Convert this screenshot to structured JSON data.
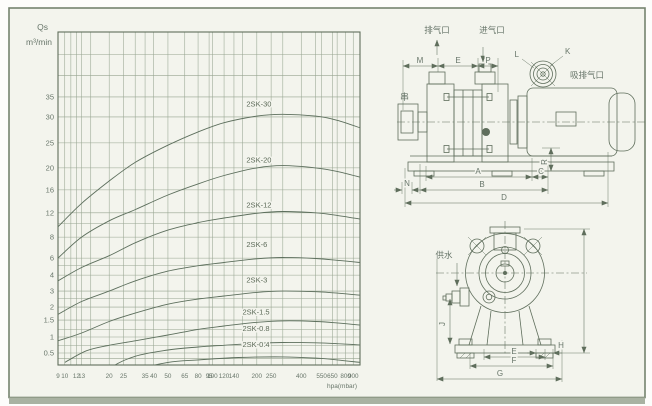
{
  "colors": {
    "paper": "#f3f4ed",
    "ink": "#5f6e5c",
    "grid": "#97a591",
    "curve": "#5d6f5d",
    "text": "#68766a",
    "edge_band": "#a9b2a2",
    "frame": "#76846e"
  },
  "chart_data": {
    "type": "line",
    "title": "",
    "x_axis": {
      "unit_label": "hpa(mbar)",
      "scale": "log",
      "min": 9,
      "max": 1000,
      "tick_values": [
        9,
        10,
        12,
        13,
        20,
        25,
        35,
        40,
        50,
        65,
        80,
        95,
        100,
        120,
        140,
        200,
        250,
        400,
        550,
        650,
        800,
        900
      ],
      "extra_grid_values": [
        11,
        15,
        30,
        160,
        300,
        500,
        700,
        1000
      ]
    },
    "y_axis": {
      "label_line1": "Qs",
      "label_line2": "m³/min",
      "scale": "log-irregular",
      "tick_values": [
        35,
        30,
        25,
        20,
        16,
        12,
        8,
        6,
        4,
        3,
        2,
        1.5,
        1,
        0.5
      ],
      "extra_grid_values": [
        45,
        40,
        10,
        5,
        2.5,
        1.2,
        0.7,
        0.45
      ],
      "anchors": [
        [
          50,
          0
        ],
        [
          45,
          0.068
        ],
        [
          40,
          0.13
        ],
        [
          35,
          0.195
        ],
        [
          30,
          0.255
        ],
        [
          25,
          0.333
        ],
        [
          20,
          0.408
        ],
        [
          16,
          0.474
        ],
        [
          12,
          0.543
        ],
        [
          8,
          0.616
        ],
        [
          6,
          0.679
        ],
        [
          4,
          0.73
        ],
        [
          3,
          0.778
        ],
        [
          2,
          0.826
        ],
        [
          1.5,
          0.865
        ],
        [
          1,
          0.916
        ],
        [
          0.5,
          0.964
        ],
        [
          0.4,
          1.0
        ],
        [
          0.2,
          1.15
        ]
      ]
    },
    "legend_position": "labels-on-curves",
    "grid": true,
    "series": [
      {
        "name": "2SK-30",
        "label_at": [
          170,
          32.5
        ],
        "points": [
          [
            9,
            9.5
          ],
          [
            13,
            13.5
          ],
          [
            20,
            17.5
          ],
          [
            30,
            21
          ],
          [
            50,
            24.5
          ],
          [
            80,
            27
          ],
          [
            120,
            28.8
          ],
          [
            200,
            30.2
          ],
          [
            300,
            30.6
          ],
          [
            500,
            30.2
          ],
          [
            700,
            29.3
          ],
          [
            1000,
            27.8
          ]
        ]
      },
      {
        "name": "2SK-20",
        "label_at": [
          170,
          21
        ],
        "points": [
          [
            9,
            6
          ],
          [
            13,
            8
          ],
          [
            20,
            10.5
          ],
          [
            30,
            12.5
          ],
          [
            50,
            15
          ],
          [
            80,
            17
          ],
          [
            120,
            18.5
          ],
          [
            200,
            20
          ],
          [
            300,
            20.4
          ],
          [
            500,
            20
          ],
          [
            700,
            19.3
          ],
          [
            1000,
            18.2
          ]
        ]
      },
      {
        "name": "2SK-12",
        "label_at": [
          170,
          12.8
        ],
        "points": [
          [
            9,
            3.6
          ],
          [
            13,
            4.8
          ],
          [
            20,
            6.2
          ],
          [
            30,
            7.4
          ],
          [
            50,
            9
          ],
          [
            80,
            10.2
          ],
          [
            120,
            11
          ],
          [
            200,
            11.9
          ],
          [
            300,
            12.2
          ],
          [
            500,
            12
          ],
          [
            700,
            11.5
          ],
          [
            1000,
            10.8
          ]
        ]
      },
      {
        "name": "2SK-6",
        "label_at": [
          170,
          7
        ],
        "points": [
          [
            9,
            1.7
          ],
          [
            13,
            2.3
          ],
          [
            20,
            3
          ],
          [
            30,
            3.6
          ],
          [
            50,
            4.4
          ],
          [
            80,
            5
          ],
          [
            120,
            5.4
          ],
          [
            200,
            5.9
          ],
          [
            300,
            6.05
          ],
          [
            500,
            5.95
          ],
          [
            700,
            5.7
          ],
          [
            1000,
            5.4
          ]
        ]
      },
      {
        "name": "2SK-3",
        "label_at": [
          170,
          3.5
        ],
        "points": [
          [
            9,
            0.85
          ],
          [
            13,
            1.1
          ],
          [
            20,
            1.45
          ],
          [
            30,
            1.75
          ],
          [
            50,
            2.15
          ],
          [
            80,
            2.45
          ],
          [
            120,
            2.65
          ],
          [
            200,
            2.9
          ],
          [
            300,
            3
          ],
          [
            500,
            2.95
          ],
          [
            700,
            2.85
          ],
          [
            1000,
            2.7
          ]
        ]
      },
      {
        "name": "2SK-1.5",
        "label_at": [
          160,
          1.7
        ],
        "points": [
          [
            10,
            0.42
          ],
          [
            14,
            0.55
          ],
          [
            20,
            0.7
          ],
          [
            30,
            0.85
          ],
          [
            50,
            1.05
          ],
          [
            80,
            1.2
          ],
          [
            120,
            1.3
          ],
          [
            200,
            1.42
          ],
          [
            300,
            1.47
          ],
          [
            500,
            1.45
          ],
          [
            700,
            1.4
          ],
          [
            1000,
            1.33
          ]
        ]
      },
      {
        "name": "2SK-0.8",
        "label_at": [
          160,
          1.15
        ],
        "points": [
          [
            12,
            0.26
          ],
          [
            20,
            0.38
          ],
          [
            30,
            0.47
          ],
          [
            50,
            0.57
          ],
          [
            80,
            0.65
          ],
          [
            120,
            0.7
          ],
          [
            200,
            0.76
          ],
          [
            300,
            0.79
          ],
          [
            500,
            0.78
          ],
          [
            700,
            0.75
          ],
          [
            1000,
            0.71
          ]
        ]
      },
      {
        "name": "2SK-0.4",
        "label_at": [
          160,
          0.65
        ],
        "points": [
          [
            14,
            0.2
          ],
          [
            20,
            0.3
          ],
          [
            30,
            0.37
          ],
          [
            50,
            0.42
          ],
          [
            80,
            0.44
          ],
          [
            150,
            0.46
          ],
          [
            300,
            0.465
          ],
          [
            500,
            0.455
          ],
          [
            700,
            0.44
          ],
          [
            1000,
            0.42
          ]
        ]
      }
    ]
  },
  "side_view": {
    "exhaust_port": "排气口",
    "intake_port": "进气口",
    "suction_exhaust_port": "吸排气口",
    "mark": "串",
    "dim_m": "M",
    "dim_e": "E",
    "dim_p": "P",
    "dim_l": "L",
    "dim_k": "K",
    "dim_a": "A",
    "dim_b": "B",
    "dim_c": "C",
    "dim_d": "D",
    "dim_n": "N",
    "dim_r": "R"
  },
  "front_view": {
    "water_supply": "供水",
    "dim_e": "E",
    "dim_f": "F",
    "dim_g": "G",
    "dim_h": "H",
    "dim_j": "J"
  }
}
